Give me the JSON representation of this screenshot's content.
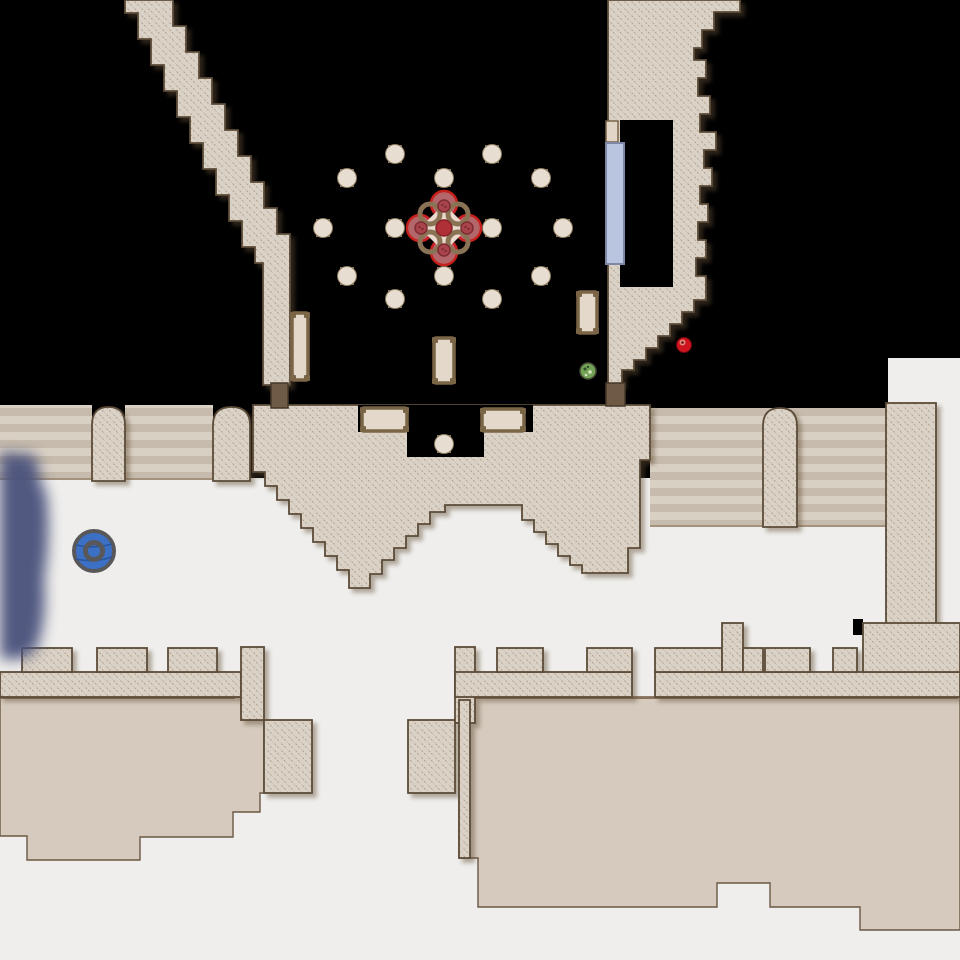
{
  "meta": {
    "app": "dungeon-automap",
    "view": "level-map",
    "width": 960,
    "height": 960
  },
  "palette": {
    "void": "#000000",
    "floor_white": "#efeeec",
    "floor_tan": "#d5cabd",
    "floor_tan_line": "#8a7258",
    "wall_fill": "#dad2c6",
    "wall_hatch": "#b3a28d",
    "wall_stroke": "#5c4b38",
    "stairs_light": "#d9d0c4",
    "stairs_dark": "#c6bbac",
    "stairs_edge": "#a4927c",
    "door_brown": "#6f5b45",
    "door_brown_stroke": "#46382a",
    "glass_fill": "#b9c5df",
    "glass_stroke": "#7e88a6",
    "recess_fill": "#e0d5c6",
    "pillar_fill": "#e7ddd0",
    "pillar_tab": "#8a795c",
    "table_fill": "#e3d8c9",
    "table_stroke": "#7b6547",
    "flower_petal": "#b5666b",
    "flower_petal_stroke": "#c5201d",
    "flower_ring": "#8a7354",
    "flower_cream": "#ead9cd",
    "flower_core": "#b03038",
    "flower_core_stroke": "#872028",
    "flower_knob": "#a8444a",
    "flower_knob_stroke": "#7c2d33",
    "orb_blue": "#3b70c5",
    "orb_ring": "#58585a",
    "orb_wave": "#2a549c",
    "fog_navy": "#4b527d",
    "green_orb": "#74a257",
    "green_orb_stroke": "#474f38",
    "green_dot_dark": "#2f4d2a",
    "green_dot_light": "#d9e4c2",
    "red_item": "#cf1420",
    "red_item_light": "#e08a80",
    "red_item_stroke": "#70090f"
  },
  "floors": {
    "white_rects": [
      [
        0,
        478,
        960,
        482
      ],
      [
        888,
        358,
        72,
        47
      ],
      [
        936,
        400,
        24,
        80
      ]
    ],
    "tan_polys": [
      [
        [
          0,
          697
        ],
        [
          241,
          697
        ],
        [
          241,
          720
        ],
        [
          264,
          720
        ],
        [
          264,
          793
        ],
        [
          260,
          793
        ],
        [
          260,
          812
        ],
        [
          233,
          812
        ],
        [
          233,
          837
        ],
        [
          140,
          837
        ],
        [
          140,
          860
        ],
        [
          27,
          860
        ],
        [
          27,
          836
        ],
        [
          0,
          836
        ]
      ],
      [
        [
          459,
          697
        ],
        [
          960,
          697
        ],
        [
          960,
          930
        ],
        [
          860,
          930
        ],
        [
          860,
          907
        ],
        [
          770,
          907
        ],
        [
          770,
          883
        ],
        [
          717,
          883
        ],
        [
          717,
          907
        ],
        [
          478,
          907
        ],
        [
          478,
          858
        ],
        [
          459,
          858
        ]
      ]
    ],
    "tan_rects": [
      [
        650,
        483,
        23,
        44
      ],
      [
        768,
        483,
        25,
        44
      ],
      [
        890,
        487,
        35,
        136
      ]
    ],
    "tan_top_lines": [
      [
        0,
        698,
        235,
        698
      ],
      [
        459,
        698,
        958,
        698
      ]
    ],
    "black_notches": [
      [
        853,
        619,
        10,
        16
      ],
      [
        886,
        523,
        12,
        112
      ]
    ]
  },
  "stairs": {
    "rects": [
      [
        0,
        405,
        92,
        75
      ],
      [
        125,
        405,
        88,
        75
      ],
      [
        650,
        408,
        236,
        119
      ]
    ],
    "edge_lines": [
      [
        0,
        479,
        92,
        479
      ],
      [
        125,
        479,
        213,
        479
      ],
      [
        650,
        526,
        886,
        526
      ]
    ]
  },
  "arches": [
    {
      "x": 92,
      "y": 407,
      "w": 33,
      "h": 74
    },
    {
      "x": 213,
      "y": 407,
      "w": 37,
      "h": 74
    },
    {
      "x": 763,
      "y": 408,
      "w": 34,
      "h": 119
    }
  ],
  "walls": {
    "polys": [
      {
        "name": "wall-diagonal-corridor",
        "points": [
          [
            125,
            0
          ],
          [
            125,
            13
          ],
          [
            138,
            13
          ],
          [
            138,
            39
          ],
          [
            151,
            39
          ],
          [
            151,
            65
          ],
          [
            164,
            65
          ],
          [
            164,
            91
          ],
          [
            177,
            91
          ],
          [
            177,
            117
          ],
          [
            190,
            117
          ],
          [
            190,
            143
          ],
          [
            203,
            143
          ],
          [
            203,
            169
          ],
          [
            216,
            169
          ],
          [
            216,
            195
          ],
          [
            229,
            195
          ],
          [
            229,
            221
          ],
          [
            242,
            221
          ],
          [
            242,
            247
          ],
          [
            255,
            247
          ],
          [
            255,
            263
          ],
          [
            263,
            263
          ],
          [
            263,
            385
          ],
          [
            290,
            385
          ],
          [
            290,
            234
          ],
          [
            277,
            234
          ],
          [
            277,
            208
          ],
          [
            264,
            208
          ],
          [
            264,
            182
          ],
          [
            251,
            182
          ],
          [
            251,
            156
          ],
          [
            238,
            156
          ],
          [
            238,
            130
          ],
          [
            225,
            130
          ],
          [
            225,
            104
          ],
          [
            212,
            104
          ],
          [
            212,
            78
          ],
          [
            199,
            78
          ],
          [
            199,
            52
          ],
          [
            186,
            52
          ],
          [
            186,
            26
          ],
          [
            173,
            26
          ],
          [
            173,
            0
          ]
        ]
      },
      {
        "name": "wall-top-right-mass",
        "points": [
          [
            608,
            0
          ],
          [
            740,
            0
          ],
          [
            740,
            12
          ],
          [
            714,
            12
          ],
          [
            714,
            30
          ],
          [
            702,
            30
          ],
          [
            702,
            48
          ],
          [
            694,
            48
          ],
          [
            694,
            60
          ],
          [
            706,
            60
          ],
          [
            706,
            78
          ],
          [
            698,
            78
          ],
          [
            698,
            96
          ],
          [
            710,
            96
          ],
          [
            710,
            114
          ],
          [
            700,
            114
          ],
          [
            700,
            132
          ],
          [
            716,
            132
          ],
          [
            716,
            150
          ],
          [
            704,
            150
          ],
          [
            704,
            168
          ],
          [
            712,
            168
          ],
          [
            712,
            186
          ],
          [
            700,
            186
          ],
          [
            700,
            204
          ],
          [
            708,
            204
          ],
          [
            708,
            222
          ],
          [
            698,
            222
          ],
          [
            698,
            240
          ],
          [
            706,
            240
          ],
          [
            706,
            258
          ],
          [
            696,
            258
          ],
          [
            696,
            276
          ],
          [
            706,
            276
          ],
          [
            706,
            300
          ],
          [
            694,
            300
          ],
          [
            694,
            312
          ],
          [
            682,
            312
          ],
          [
            682,
            324
          ],
          [
            670,
            324
          ],
          [
            670,
            336
          ],
          [
            658,
            336
          ],
          [
            658,
            348
          ],
          [
            646,
            348
          ],
          [
            646,
            360
          ],
          [
            634,
            360
          ],
          [
            634,
            370
          ],
          [
            622,
            370
          ],
          [
            622,
            385
          ],
          [
            608,
            385
          ]
        ]
      },
      {
        "name": "wall-middle-band",
        "points": [
          [
            253,
            405
          ],
          [
            253,
            472
          ],
          [
            265,
            472
          ],
          [
            265,
            486
          ],
          [
            277,
            486
          ],
          [
            277,
            500
          ],
          [
            289,
            500
          ],
          [
            289,
            514
          ],
          [
            301,
            514
          ],
          [
            301,
            528
          ],
          [
            313,
            528
          ],
          [
            313,
            542
          ],
          [
            325,
            542
          ],
          [
            325,
            556
          ],
          [
            337,
            556
          ],
          [
            337,
            570
          ],
          [
            349,
            570
          ],
          [
            349,
            588
          ],
          [
            370,
            588
          ],
          [
            370,
            574
          ],
          [
            382,
            574
          ],
          [
            382,
            560
          ],
          [
            394,
            560
          ],
          [
            394,
            548
          ],
          [
            406,
            548
          ],
          [
            406,
            536
          ],
          [
            418,
            536
          ],
          [
            418,
            524
          ],
          [
            430,
            524
          ],
          [
            430,
            512
          ],
          [
            445,
            512
          ],
          [
            445,
            505
          ],
          [
            522,
            505
          ],
          [
            522,
            520
          ],
          [
            534,
            520
          ],
          [
            534,
            532
          ],
          [
            546,
            532
          ],
          [
            546,
            544
          ],
          [
            558,
            544
          ],
          [
            558,
            556
          ],
          [
            570,
            556
          ],
          [
            570,
            565
          ],
          [
            582,
            565
          ],
          [
            582,
            573
          ],
          [
            628,
            573
          ],
          [
            628,
            548
          ],
          [
            640,
            548
          ],
          [
            640,
            460
          ],
          [
            650,
            460
          ],
          [
            650,
            405
          ]
        ]
      }
    ],
    "rects": [
      {
        "name": "wall-right-column",
        "r": [
          886,
          403,
          50,
          242
        ]
      },
      {
        "name": "wall-bl-band",
        "r": [
          0,
          672,
          241,
          25
        ]
      },
      {
        "name": "wall-bl-tooth",
        "r": [
          22,
          648,
          50,
          24
        ]
      },
      {
        "name": "wall-bl-tooth",
        "r": [
          97,
          648,
          50,
          24
        ]
      },
      {
        "name": "wall-bl-tooth",
        "r": [
          168,
          648,
          49,
          24
        ]
      },
      {
        "name": "wall-bl-column",
        "r": [
          241,
          647,
          23,
          73
        ]
      },
      {
        "name": "wall-bl-column",
        "r": [
          264,
          720,
          48,
          73
        ]
      },
      {
        "name": "wall-block",
        "r": [
          408,
          720,
          47,
          73
        ]
      },
      {
        "name": "wall-br-column",
        "r": [
          455,
          647,
          20,
          76
        ]
      },
      {
        "name": "wall-br-band",
        "r": [
          455,
          672,
          177,
          25
        ]
      },
      {
        "name": "wall-br-band",
        "r": [
          655,
          672,
          305,
          25
        ]
      },
      {
        "name": "wall-br-tooth",
        "r": [
          497,
          648,
          46,
          24
        ]
      },
      {
        "name": "wall-br-tooth",
        "r": [
          587,
          648,
          45,
          24
        ]
      },
      {
        "name": "wall-br-tooth",
        "r": [
          655,
          648,
          67,
          24
        ]
      },
      {
        "name": "wall-br-tooth-tall",
        "r": [
          722,
          623,
          21,
          49
        ]
      },
      {
        "name": "wall-br-tooth",
        "r": [
          743,
          648,
          20,
          24
        ]
      },
      {
        "name": "wall-br-tooth",
        "r": [
          765,
          648,
          45,
          24
        ]
      },
      {
        "name": "wall-br-tooth",
        "r": [
          833,
          648,
          24,
          24
        ]
      },
      {
        "name": "wall-br-right-block",
        "r": [
          863,
          623,
          97,
          49
        ]
      },
      {
        "name": "wall-room-inner-strip",
        "r": [
          459,
          700,
          11,
          158
        ]
      }
    ],
    "black_cutouts": [
      [
        620,
        120,
        53,
        167
      ],
      [
        358,
        405,
        49,
        27
      ],
      [
        407,
        405,
        77,
        52
      ],
      [
        483,
        405,
        50,
        27
      ]
    ]
  },
  "features": {
    "recess_door": [
      606,
      121,
      12,
      21
    ],
    "glass_door": [
      606,
      143,
      18,
      121
    ],
    "brown_doors": [
      [
        271,
        383,
        17,
        25
      ],
      [
        606,
        383,
        19,
        23
      ]
    ],
    "tables_v": [
      [
        292,
        313,
        16,
        67
      ],
      [
        434,
        338,
        20,
        45
      ],
      [
        578,
        292,
        19,
        41
      ]
    ],
    "tables_h": [
      [
        362,
        408,
        45,
        23
      ],
      [
        482,
        409,
        42,
        22
      ]
    ],
    "pillars": [
      [
        395,
        154
      ],
      [
        492,
        154
      ],
      [
        347,
        178
      ],
      [
        444,
        178
      ],
      [
        541,
        178
      ],
      [
        323,
        228
      ],
      [
        395,
        228
      ],
      [
        492,
        228
      ],
      [
        563,
        228
      ],
      [
        347,
        276
      ],
      [
        444,
        276
      ],
      [
        541,
        276
      ],
      [
        395,
        299
      ],
      [
        492,
        299
      ],
      [
        444,
        444
      ]
    ],
    "flower": {
      "cx": 444,
      "cy": 228
    },
    "blue_orb": {
      "cx": 94,
      "cy": 551,
      "r": 20
    },
    "green_orb": {
      "cx": 588,
      "cy": 371,
      "r": 8
    },
    "red_item": {
      "cx": 684,
      "cy": 345,
      "r": 7.5
    },
    "fog": {
      "path": "M 0,452 L 34,455 C 42,468 36,480 46,492 C 50,520 48,555 44,580 C 46,605 44,625 38,645 C 30,662 10,660 0,658 Z",
      "blur": 7
    }
  }
}
